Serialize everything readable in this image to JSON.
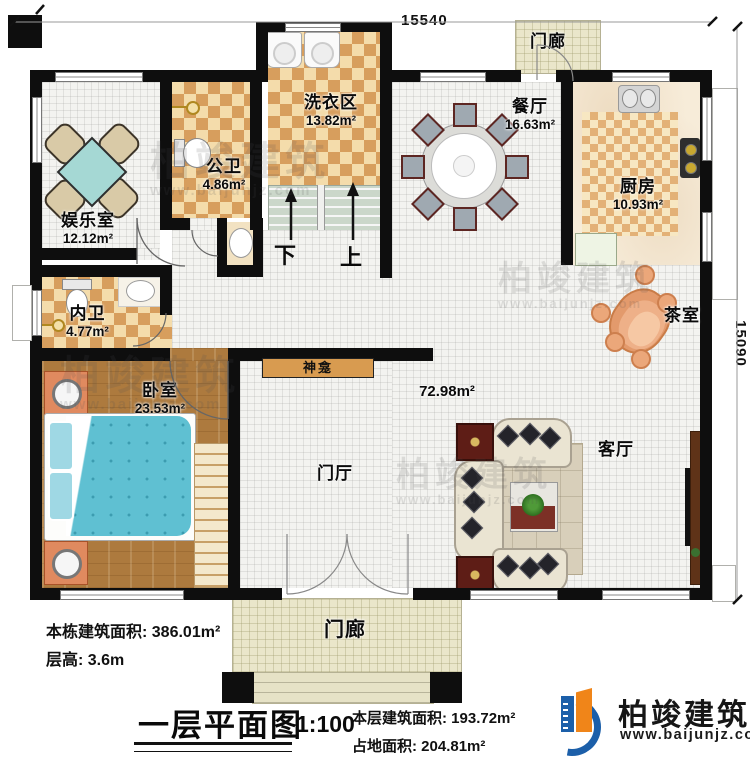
{
  "dimensions": {
    "top": "15540",
    "right": "15090"
  },
  "rooms": {
    "entertainment": {
      "name": "娱乐室",
      "area": "12.12m²"
    },
    "public_bath": {
      "name": "公卫",
      "area": "4.86m²"
    },
    "laundry": {
      "name": "洗衣区",
      "area": "13.82m²"
    },
    "dining": {
      "name": "餐厅",
      "area": "16.63m²"
    },
    "kitchen": {
      "name": "厨房",
      "area": "10.93m²"
    },
    "inner_bath": {
      "name": "内卫",
      "area": "4.77m²"
    },
    "bedroom": {
      "name": "卧室",
      "area": "23.53m²"
    },
    "tea_room": {
      "name": "茶室"
    },
    "living": {
      "name": "客厅"
    },
    "foyer": {
      "name": "门厅"
    },
    "hall_area": "72.98m²",
    "shrine": "神龛",
    "porch_top": "门廊",
    "porch_bottom": "门廊"
  },
  "stairs": {
    "down": "下",
    "up": "上"
  },
  "info": {
    "building_area_label": "本栋建筑面积: 386.01m²",
    "floor_height_label": "层高: 3.6m"
  },
  "title": {
    "main": "一层平面图",
    "scale": "1:100",
    "floor_area": "本层建筑面积: 193.72m²",
    "footprint": "占地面积: 204.81m²"
  },
  "brand": {
    "name": "柏竣建筑",
    "url": "www.baijunjz.com",
    "colors": {
      "blue": "#1c5fa9",
      "orange": "#f08519"
    }
  },
  "watermark": {
    "name": "柏竣建筑",
    "url": "www.baijunjz.com"
  }
}
